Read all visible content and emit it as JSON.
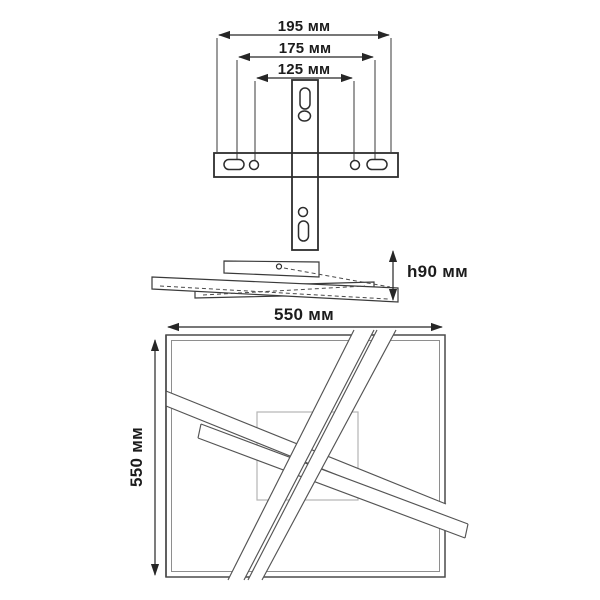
{
  "canvas": {
    "background": "#ffffff",
    "ink": "#2d2d2d"
  },
  "dimensions": {
    "bracket_outer": "195 мм",
    "bracket_middle": "175 мм",
    "bracket_inner": "125 мм",
    "fixture_height": "h90 мм",
    "fixture_width": "550 мм",
    "fixture_depth": "550 мм"
  },
  "views": {
    "bracket_front": "mounting-bracket-front-view",
    "fixture_side": "fixture-side-profile-view",
    "fixture_top": "fixture-top-view"
  }
}
